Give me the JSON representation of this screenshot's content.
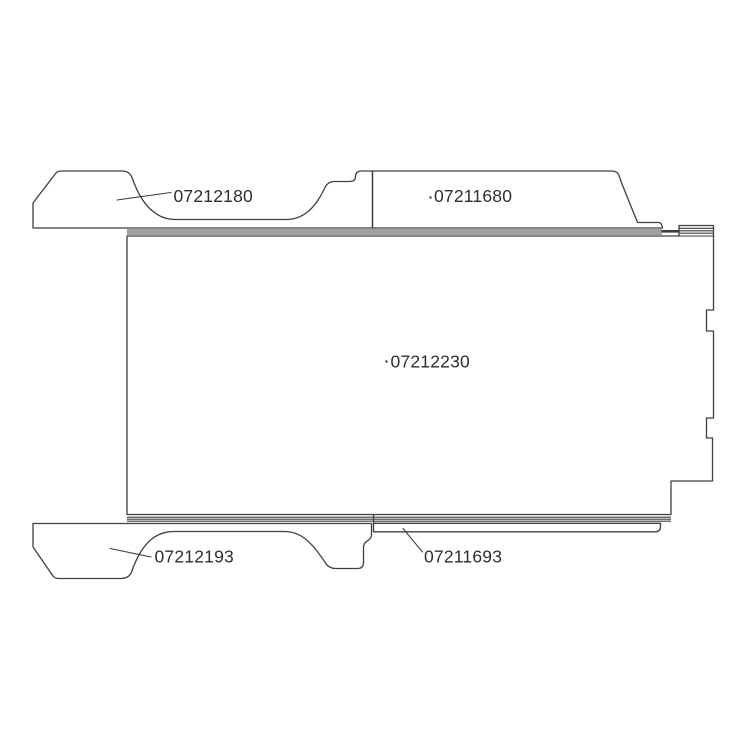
{
  "diagram": {
    "line_color": "#3f3f3f",
    "text_color": "#2e2e2e",
    "background_color": "#ffffff",
    "parts": [
      {
        "name": "top-left-panel",
        "part_number": "07212180"
      },
      {
        "name": "top-right-panel",
        "part_number": "07211680"
      },
      {
        "name": "main-floor-panel",
        "part_number": "07212230"
      },
      {
        "name": "bottom-left-panel",
        "part_number": "07212193"
      },
      {
        "name": "bottom-sill-strip",
        "part_number": "07211693"
      }
    ]
  }
}
